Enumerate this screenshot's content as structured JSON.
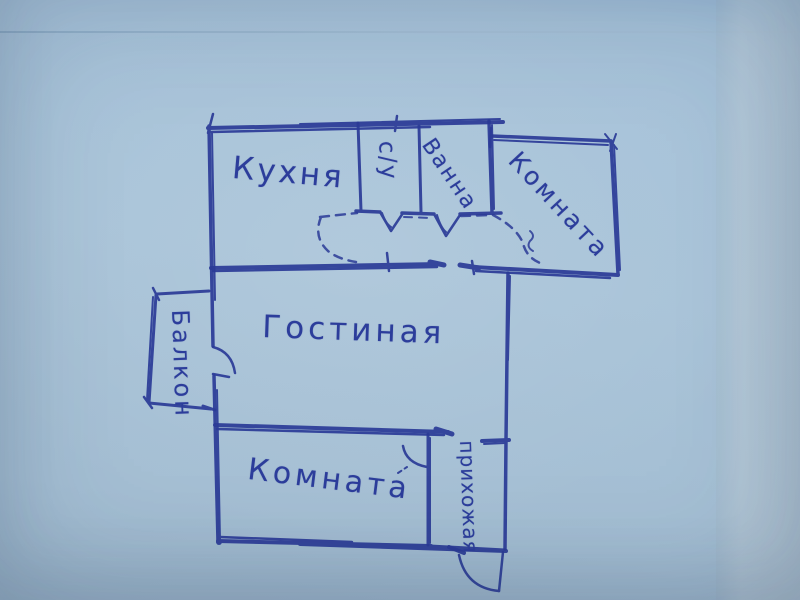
{
  "document": {
    "kind": "hand-drawn apartment floor plan (photo of pen sketch on paper)",
    "language": "ru"
  },
  "colors": {
    "ink": "#2b3b97",
    "paper": "#a7c2d8"
  },
  "rooms": [
    {
      "id": "kitchen",
      "label": "Кухня"
    },
    {
      "id": "wc",
      "label": "с/у"
    },
    {
      "id": "bathroom",
      "label": "Ванна"
    },
    {
      "id": "room-top",
      "label": "Комната"
    },
    {
      "id": "living-room",
      "label": "Гостиная"
    },
    {
      "id": "balcony",
      "label": "Балкон"
    },
    {
      "id": "room-bottom",
      "label": "Комната"
    },
    {
      "id": "hallway",
      "label": "прихожая"
    }
  ]
}
